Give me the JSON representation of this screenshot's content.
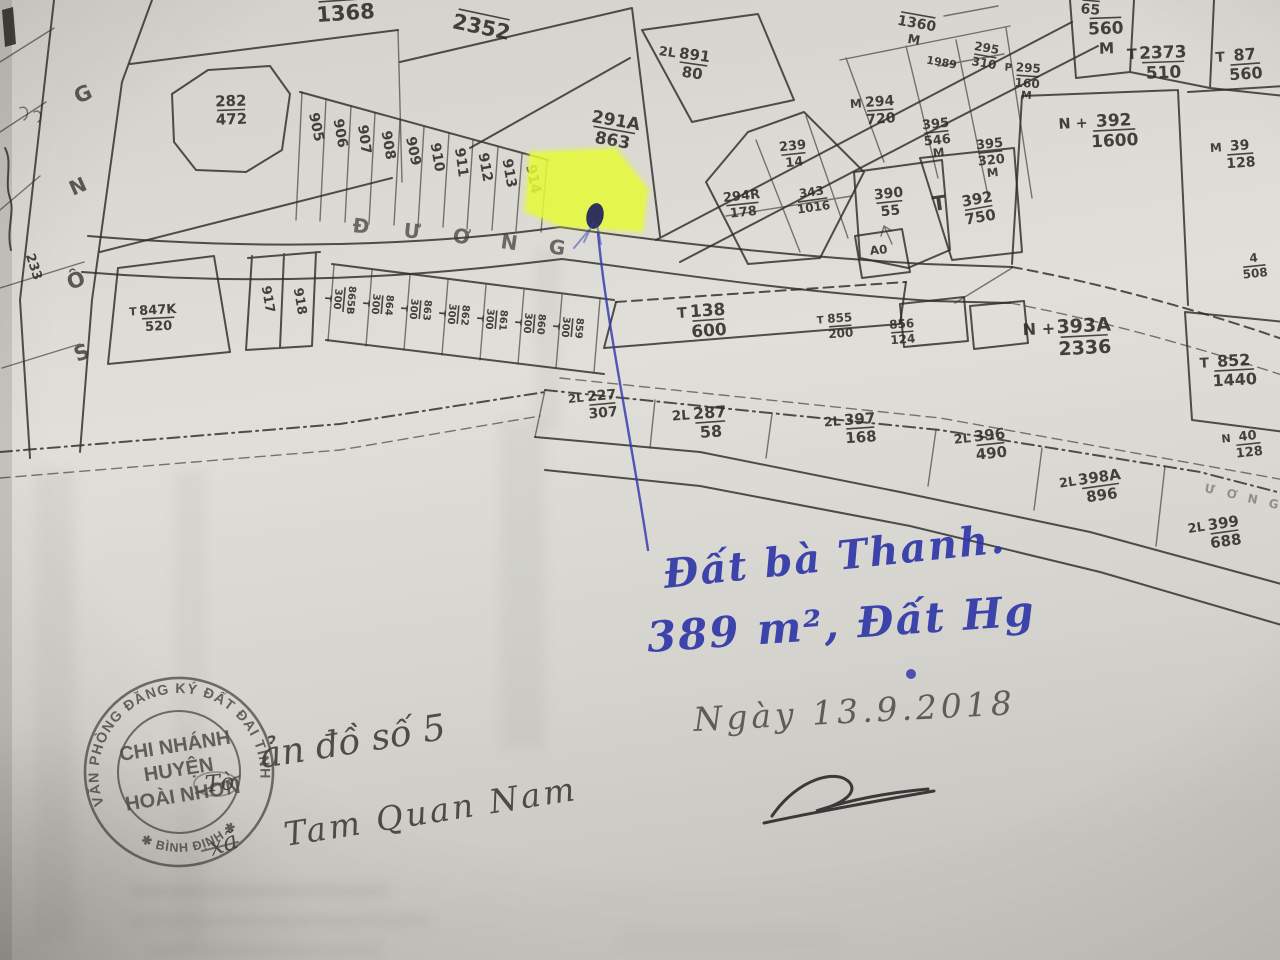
{
  "map": {
    "road_name_horizontal": "ĐƯỜNG",
    "parcels": [
      {
        "n": "1368",
        "over": true,
        "x": 346,
        "y": 20,
        "r": -4,
        "sz": 21
      },
      {
        "n": "2352",
        "over": true,
        "x": 480,
        "y": 34,
        "r": 12,
        "sz": 21
      },
      {
        "n": "282",
        "d": "472",
        "x": 231,
        "y": 106,
        "r": -2,
        "sz": 15
      },
      {
        "n": "905",
        "x": 312,
        "y": 128,
        "r": 78,
        "sz": 14
      },
      {
        "n": "906",
        "x": 336,
        "y": 134,
        "r": 80,
        "sz": 14
      },
      {
        "n": "907",
        "x": 360,
        "y": 140,
        "r": 82,
        "sz": 14
      },
      {
        "n": "908",
        "x": 384,
        "y": 146,
        "r": 80,
        "sz": 14
      },
      {
        "n": "909",
        "x": 409,
        "y": 152,
        "r": 78,
        "sz": 14
      },
      {
        "n": "910",
        "x": 433,
        "y": 158,
        "r": 80,
        "sz": 14
      },
      {
        "n": "911",
        "x": 457,
        "y": 163,
        "r": 82,
        "sz": 14
      },
      {
        "n": "912",
        "x": 481,
        "y": 168,
        "r": 80,
        "sz": 14
      },
      {
        "n": "913",
        "x": 505,
        "y": 174,
        "r": 80,
        "sz": 14
      },
      {
        "n": "914",
        "x": 529,
        "y": 180,
        "r": 78,
        "sz": 14
      },
      {
        "n": "291A",
        "d": "863",
        "x": 615,
        "y": 126,
        "r": 10,
        "sz": 17
      },
      {
        "p": "2L",
        "n": "891",
        "d": "80",
        "x": 694,
        "y": 60,
        "r": 8,
        "sz": 15
      },
      {
        "n": "65",
        "over": true,
        "x": 1090,
        "y": 14,
        "r": 5,
        "sz": 14
      },
      {
        "n": "1360",
        "s": "M",
        "over": true,
        "x": 916,
        "y": 28,
        "r": 10,
        "sz": 14
      },
      {
        "n": "1989",
        "x": 941,
        "y": 66,
        "r": 10,
        "sz": 11
      },
      {
        "n": "295",
        "d": "310",
        "x": 986,
        "y": 52,
        "r": 10,
        "sz": 12
      },
      {
        "p": "P",
        "n": "295",
        "d": "160",
        "s": "M",
        "x": 1028,
        "y": 72,
        "r": 4,
        "sz": 12
      },
      {
        "n": "560",
        "s": "M",
        "over": true,
        "x": 1106,
        "y": 34,
        "r": -2,
        "sz": 17
      },
      {
        "p": "T",
        "n": "2373",
        "d": "510",
        "x": 1163,
        "y": 58,
        "r": -2,
        "sz": 17
      },
      {
        "p": "T",
        "n": "87",
        "d": "560",
        "x": 1245,
        "y": 60,
        "r": -4,
        "sz": 16
      },
      {
        "p": "M",
        "n": "294",
        "d": "720",
        "x": 880,
        "y": 106,
        "r": -4,
        "sz": 14
      },
      {
        "n": "395",
        "d": "546",
        "s": "M",
        "x": 936,
        "y": 128,
        "r": -6,
        "sz": 13
      },
      {
        "n": "395",
        "d": "320",
        "s": "M",
        "x": 990,
        "y": 148,
        "r": -6,
        "sz": 13
      },
      {
        "p": "N +",
        "n": "392",
        "d": "1600",
        "x": 1114,
        "y": 126,
        "r": -3,
        "sz": 17
      },
      {
        "p": "M",
        "n": "39",
        "d": "128",
        "x": 1240,
        "y": 150,
        "r": -4,
        "sz": 14
      },
      {
        "n": "239",
        "d": "14",
        "x": 793,
        "y": 150,
        "r": -6,
        "sz": 13
      },
      {
        "n": "343",
        "d": "1016",
        "x": 812,
        "y": 196,
        "r": -8,
        "sz": 12
      },
      {
        "n": "294R",
        "d": "178",
        "x": 742,
        "y": 200,
        "r": -6,
        "sz": 13
      },
      {
        "n": "390",
        "d": "55",
        "x": 889,
        "y": 198,
        "r": -6,
        "sz": 14
      },
      {
        "n": "392",
        "d": "750",
        "x": 978,
        "y": 204,
        "r": -10,
        "sz": 15
      },
      {
        "n": "T",
        "x": 940,
        "y": 210,
        "r": -8,
        "sz": 20
      },
      {
        "n": "A0",
        "x": 879,
        "y": 254,
        "r": -6,
        "sz": 12
      },
      {
        "n": "4",
        "d": "508",
        "x": 1254,
        "y": 262,
        "r": -6,
        "sz": 12
      },
      {
        "n": "233",
        "x": 30,
        "y": 268,
        "r": 72,
        "sz": 13
      },
      {
        "p": "T",
        "n": "847K",
        "d": "520",
        "x": 158,
        "y": 314,
        "r": -3,
        "sz": 13
      },
      {
        "n": "917",
        "x": 264,
        "y": 300,
        "r": 80,
        "sz": 13
      },
      {
        "n": "918",
        "x": 296,
        "y": 302,
        "r": 80,
        "sz": 13
      },
      {
        "n": "865B",
        "d": "300",
        "s": "T",
        "x": 348,
        "y": 300,
        "r": 95,
        "sz": 10
      },
      {
        "n": "864",
        "d": "300",
        "s": "T",
        "x": 386,
        "y": 305,
        "r": 95,
        "sz": 10
      },
      {
        "n": "863",
        "d": "300",
        "s": "T",
        "x": 424,
        "y": 310,
        "r": 95,
        "sz": 10
      },
      {
        "n": "862",
        "d": "300",
        "s": "T",
        "x": 462,
        "y": 315,
        "r": 95,
        "sz": 10
      },
      {
        "n": "861",
        "d": "300",
        "s": "T",
        "x": 500,
        "y": 320,
        "r": 95,
        "sz": 10
      },
      {
        "n": "860",
        "d": "300",
        "s": "T",
        "x": 538,
        "y": 324,
        "r": 95,
        "sz": 10
      },
      {
        "n": "859",
        "d": "300",
        "s": "T",
        "x": 576,
        "y": 328,
        "r": 95,
        "sz": 10
      },
      {
        "p": "T",
        "n": "138",
        "d": "600",
        "x": 708,
        "y": 316,
        "r": -4,
        "sz": 17
      },
      {
        "p": "T",
        "n": "855",
        "d": "200",
        "x": 840,
        "y": 322,
        "r": -4,
        "sz": 12
      },
      {
        "n": "856",
        "d": "124",
        "x": 902,
        "y": 328,
        "r": -4,
        "sz": 12
      },
      {
        "p": "N +",
        "n": "393A",
        "d": "2336",
        "x": 1084,
        "y": 332,
        "r": -3,
        "sz": 19
      },
      {
        "p": "T",
        "n": "852",
        "d": "1440",
        "x": 1234,
        "y": 366,
        "r": -3,
        "sz": 16
      },
      {
        "p": "N",
        "n": "40",
        "d": "128",
        "x": 1248,
        "y": 440,
        "r": -6,
        "sz": 13
      },
      {
        "p": "2L",
        "n": "227",
        "d": "307",
        "x": 602,
        "y": 400,
        "r": -5,
        "sz": 14
      },
      {
        "p": "2L",
        "n": "287",
        "d": "58",
        "x": 710,
        "y": 418,
        "r": -4,
        "sz": 16
      },
      {
        "p": "2L",
        "n": "397",
        "d": "168",
        "x": 860,
        "y": 424,
        "r": -4,
        "sz": 15
      },
      {
        "p": "2L",
        "n": "396",
        "d": "490",
        "x": 990,
        "y": 440,
        "r": -6,
        "sz": 15
      },
      {
        "p": "2L",
        "n": "398A",
        "d": "896",
        "x": 1100,
        "y": 482,
        "r": -8,
        "sz": 15
      },
      {
        "p": "2L",
        "n": "399",
        "d": "688",
        "x": 1224,
        "y": 528,
        "r": -8,
        "sz": 15
      }
    ],
    "road_letters": [
      {
        "ch": "Đ",
        "x": 352,
        "y": 232,
        "r": 6,
        "sz": 20,
        "o": 0.7
      },
      {
        "ch": "Ư",
        "x": 403,
        "y": 237,
        "r": 6,
        "sz": 20,
        "o": 0.7
      },
      {
        "ch": "Ơ",
        "x": 452,
        "y": 242,
        "r": 8,
        "sz": 20,
        "o": 0.7
      },
      {
        "ch": "N",
        "x": 500,
        "y": 248,
        "r": 8,
        "sz": 20,
        "o": 0.7
      },
      {
        "ch": "G",
        "x": 548,
        "y": 253,
        "r": 8,
        "sz": 20,
        "o": 0.7
      },
      {
        "ch": "G",
        "x": 78,
        "y": 104,
        "r": -24,
        "sz": 21,
        "o": 0.8
      },
      {
        "ch": "N",
        "x": 73,
        "y": 196,
        "r": -24,
        "sz": 20,
        "o": 0.8
      },
      {
        "ch": "Ô",
        "x": 70,
        "y": 290,
        "r": -20,
        "sz": 21,
        "o": 0.8
      },
      {
        "ch": "S",
        "x": 77,
        "y": 362,
        "r": -20,
        "sz": 21,
        "o": 0.8
      },
      {
        "ch": "Ư",
        "x": 1204,
        "y": 492,
        "r": 11,
        "sz": 12,
        "o": 0.45
      },
      {
        "ch": "Ơ",
        "x": 1226,
        "y": 497,
        "r": 11,
        "sz": 12,
        "o": 0.45
      },
      {
        "ch": "N",
        "x": 1247,
        "y": 502,
        "r": 11,
        "sz": 12,
        "o": 0.45
      },
      {
        "ch": "G",
        "x": 1268,
        "y": 507,
        "r": 11,
        "sz": 12,
        "o": 0.45
      }
    ]
  },
  "highlight": {
    "color": "#e6fa3a"
  },
  "handwriting": {
    "pen_color": "#2c33a6",
    "line1": "Đất bà Thanh.",
    "line2": "389 m², Đất Hg",
    "date": "Ngày 13.9.2018",
    "note_line1": "ản đồ số 5",
    "note_line2": "Tam Quan Nam",
    "note_xa": "xã",
    "note_to": "Tờ"
  },
  "stamp": {
    "ink_color": "#45423d",
    "ring_text": "VĂN PHÒNG ĐĂNG KÝ ĐẤT ĐAI TỈNH",
    "ring_text_bottom": "✱ BÌNH ĐỊNH ✱",
    "line1": "CHI NHÁNH",
    "line2": "HUYỆN",
    "line3": "HOÀI NHƠN"
  }
}
